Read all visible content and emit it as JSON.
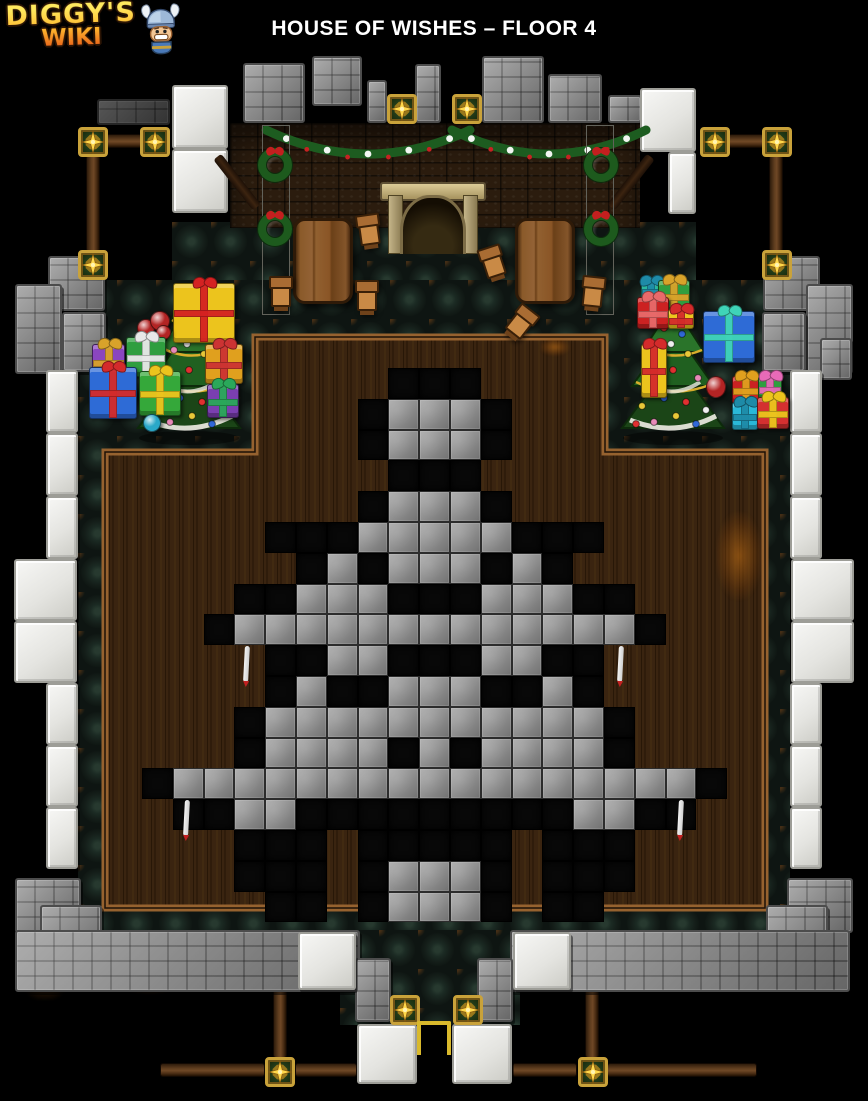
{
  "header": {
    "logo_line1": "DIGGY'S",
    "logo_line2": "WIKI",
    "title": "HOUSE OF WISHES – FLOOR 4"
  },
  "palette": {
    "gold_star": "#ffd84a",
    "star_frame": "#c9a23a",
    "wood_beam": "#5d3c1e",
    "stone": "#8d8d8d",
    "marble": "#eeeeea",
    "brick": "#2b1c0e",
    "carpet": "#141d1a",
    "room_wood": "#3a2410",
    "room_frame": "#96622f",
    "tile_gray": "#979797",
    "tile_black": "#080808",
    "garland_green": "#1d5c20"
  },
  "map": {
    "width": 868,
    "height": 1101,
    "tree_grid": {
      "origin_x": 142,
      "origin_y": 368,
      "tile": 30.8,
      "legend": {
        "G": "stone-floor-tile",
        "B": "dug-black-tile",
        ".": "wood-floor"
      },
      "rows": [
        "........BBB........",
        ".......BGGGB.......",
        ".......BGGGB.......",
        "........BBB........",
        ".......BGGGB.......",
        "....BBBGGGGGBBB....",
        ".....BGBGGGBGB.....",
        "...BBGGGBBBGGGBB...",
        "..BGGGGGGGGGGGGGB..",
        "....BBGGBBBGGBB....",
        "....BGBBGGGBBGB....",
        "...BGGGGGGGGGGGB...",
        "...BGGGGBGBGGGGB...",
        "BGGGGGGGGGGGGGGGGGB",
        ".BBGGBBBBBBBBBGGBB.",
        "...BBB.BBBBB.BBB...",
        "...BBB.BGGGB.BBB...",
        "....BB.BGGGB.BB...."
      ]
    },
    "carpets": [
      [
        172,
        222,
        524,
        100
      ],
      [
        78,
        280,
        712,
        657
      ],
      [
        340,
        930,
        180,
        95
      ]
    ],
    "room_outline": "M105,452 L255,452 L255,337 L605,337 L605,452 L765,452 L765,908 L105,908 Z",
    "scuffs": [
      [
        148,
        366,
        74,
        36
      ],
      [
        716,
        512,
        46,
        88
      ],
      [
        112,
        948,
        76,
        46
      ],
      [
        16,
        930,
        58,
        70
      ],
      [
        540,
        338,
        30,
        18
      ]
    ],
    "stones": [
      [
        97,
        99,
        73,
        26,
        "dark"
      ],
      [
        243,
        63,
        62,
        60
      ],
      [
        312,
        56,
        50,
        50
      ],
      [
        367,
        80,
        20,
        43
      ],
      [
        415,
        64,
        26,
        59
      ],
      [
        482,
        56,
        62,
        67
      ],
      [
        548,
        74,
        54,
        49
      ],
      [
        608,
        95,
        34,
        28
      ],
      [
        48,
        256,
        57,
        55
      ],
      [
        15,
        284,
        47,
        90
      ],
      [
        62,
        312,
        44,
        60
      ],
      [
        763,
        256,
        57,
        55
      ],
      [
        806,
        284,
        47,
        90
      ],
      [
        762,
        312,
        44,
        60
      ],
      [
        820,
        338,
        32,
        42
      ],
      [
        15,
        878,
        66,
        55
      ],
      [
        40,
        905,
        62,
        58
      ],
      [
        787,
        878,
        66,
        55
      ],
      [
        766,
        905,
        62,
        58
      ],
      [
        15,
        930,
        345,
        62
      ],
      [
        510,
        930,
        340,
        62
      ],
      [
        355,
        958,
        36,
        64
      ],
      [
        477,
        958,
        36,
        64
      ]
    ],
    "marbles": [
      [
        172,
        85,
        56,
        64
      ],
      [
        172,
        149,
        56,
        64
      ],
      [
        640,
        88,
        56,
        64
      ],
      [
        668,
        152,
        28,
        62
      ],
      [
        46,
        370,
        32,
        63
      ],
      [
        46,
        433,
        32,
        63
      ],
      [
        46,
        496,
        32,
        63
      ],
      [
        14,
        559,
        63,
        62
      ],
      [
        14,
        621,
        63,
        62
      ],
      [
        46,
        683,
        32,
        62
      ],
      [
        46,
        745,
        32,
        62
      ],
      [
        46,
        807,
        32,
        62
      ],
      [
        790,
        370,
        32,
        63
      ],
      [
        790,
        433,
        32,
        63
      ],
      [
        790,
        496,
        32,
        63
      ],
      [
        791,
        559,
        63,
        62
      ],
      [
        791,
        621,
        63,
        62
      ],
      [
        790,
        683,
        32,
        62
      ],
      [
        790,
        745,
        32,
        62
      ],
      [
        790,
        807,
        32,
        62
      ],
      [
        298,
        932,
        58,
        58
      ],
      [
        513,
        932,
        58,
        58
      ],
      [
        357,
        1024,
        60,
        60
      ],
      [
        452,
        1024,
        60,
        60
      ]
    ],
    "bricks": [
      230,
      123,
      410,
      105
    ],
    "rafters": [
      [
        232,
        150,
        -38
      ],
      [
        626,
        150,
        38
      ]
    ],
    "garlands": [
      {
        "x1": 266,
        "x2": 470,
        "y": 130,
        "dip": 24
      },
      {
        "x1": 452,
        "x2": 646,
        "y": 130,
        "dip": 24
      }
    ],
    "wreath_columns": [
      [
        262,
        125,
        28,
        190
      ],
      [
        586,
        125,
        28,
        190
      ]
    ],
    "wreaths": [
      [
        258,
        148
      ],
      [
        258,
        212
      ],
      [
        584,
        148
      ],
      [
        584,
        212
      ]
    ],
    "fireplace": [
      385,
      182,
      96,
      72
    ],
    "tables": [
      [
        293,
        218,
        60,
        86
      ],
      [
        515,
        218,
        60,
        86
      ]
    ],
    "chairs": [
      [
        268,
        276,
        0
      ],
      [
        356,
        214,
        -8
      ],
      [
        354,
        280,
        0
      ],
      [
        480,
        246,
        -18
      ],
      [
        508,
        306,
        38
      ],
      [
        580,
        276,
        6
      ]
    ],
    "xmas_trees": [
      [
        132,
        288
      ],
      [
        616,
        288
      ]
    ],
    "gifts": [
      [
        173,
        283,
        62,
        60,
        "#ecc41d",
        "#d42222",
        "box"
      ],
      [
        137,
        311,
        36,
        32,
        "#b32424",
        "",
        "balls"
      ],
      [
        92,
        344,
        33,
        35,
        "#8a46c0",
        "#d8a32a",
        "box"
      ],
      [
        126,
        337,
        40,
        40,
        "#2f9e3f",
        "#e8e8e8",
        "box"
      ],
      [
        89,
        367,
        48,
        52,
        "#2e6bd6",
        "#d42b2b",
        "box"
      ],
      [
        139,
        371,
        42,
        45,
        "#35a83a",
        "#ecc41d",
        "box"
      ],
      [
        205,
        344,
        38,
        40,
        "#e0a01e",
        "#cc3333",
        "box"
      ],
      [
        207,
        384,
        32,
        34,
        "#7a3fb0",
        "#2aa85a",
        "box"
      ],
      [
        143,
        414,
        18,
        18,
        "#2aa8c8",
        "",
        "ball"
      ],
      [
        641,
        281,
        20,
        18,
        "#2ab89e",
        "#1e8ba8",
        "box"
      ],
      [
        658,
        280,
        32,
        32,
        "#2f9e3f",
        "#d8a32a",
        "box"
      ],
      [
        637,
        297,
        32,
        32,
        "#cc2222",
        "#e86a6a",
        "box"
      ],
      [
        668,
        309,
        26,
        20,
        "#ecc41d",
        "#d42b2b",
        "box"
      ],
      [
        703,
        311,
        52,
        52,
        "#2e6bd6",
        "#3fd4b8",
        "box"
      ],
      [
        641,
        344,
        26,
        54,
        "#ecc41d",
        "#d42b2b",
        "box"
      ],
      [
        706,
        376,
        20,
        22,
        "#b32424",
        "",
        "ball"
      ],
      [
        732,
        376,
        28,
        28,
        "#cc2222",
        "#e0a01e",
        "box"
      ],
      [
        758,
        376,
        24,
        24,
        "#2f9e3f",
        "#e86ab8",
        "box"
      ],
      [
        732,
        402,
        26,
        28,
        "#2ab8d8",
        "#1e8ba8",
        "box"
      ],
      [
        757,
        397,
        32,
        32,
        "#d43030",
        "#ecc41d",
        "box"
      ]
    ],
    "ropes": [
      [
        244,
        646
      ],
      [
        618,
        646
      ],
      [
        184,
        800
      ],
      [
        678,
        800
      ]
    ],
    "beams": [
      [
        106,
        134,
        36,
        14
      ],
      [
        86,
        155,
        14,
        97
      ],
      [
        728,
        134,
        36,
        14
      ],
      [
        769,
        155,
        14,
        97
      ],
      [
        160,
        1063,
        105,
        14
      ],
      [
        295,
        1063,
        62,
        14
      ],
      [
        512,
        1063,
        65,
        14
      ],
      [
        607,
        1063,
        150,
        14
      ],
      [
        273,
        962,
        14,
        96
      ],
      [
        585,
        962,
        14,
        96
      ]
    ],
    "stars": [
      [
        78,
        127
      ],
      [
        140,
        127
      ],
      [
        78,
        250
      ],
      [
        700,
        127
      ],
      [
        762,
        127
      ],
      [
        762,
        250
      ],
      [
        387,
        94
      ],
      [
        452,
        94
      ],
      [
        390,
        995
      ],
      [
        453,
        995
      ],
      [
        265,
        1057
      ],
      [
        578,
        1057
      ]
    ],
    "entrance": [
      417,
      1021,
      34,
      34
    ]
  }
}
